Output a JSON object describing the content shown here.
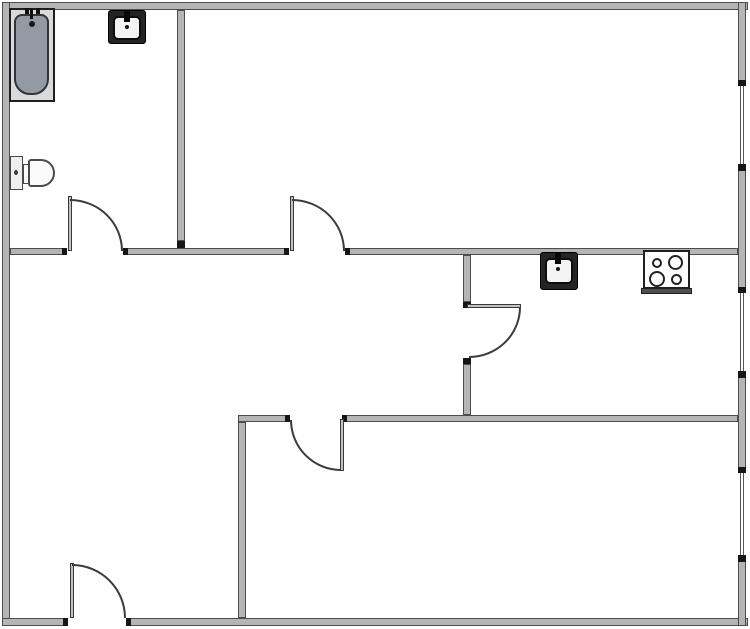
{
  "floorplan": {
    "canvas": {
      "width": 750,
      "height": 629,
      "background": "#ffffff"
    },
    "palette": {
      "wall_fill": "#b5b5b5",
      "wall_edge": "#4d4d4d",
      "jamb_black": "#161616",
      "door_line": "#3c3c3c",
      "sink_frame": "#242424",
      "sink_basin": "#f3f3f3",
      "tub_deck": "#dadada",
      "tub_basin": "#949aa3",
      "stove_fill": "#ffffff",
      "stove_front": "#4e4e4e",
      "toilet_fill": "#fbfbfb"
    },
    "walls": [
      {
        "name": "wall-exterior-top",
        "x": 2,
        "y": 2,
        "w": 746,
        "h": 8
      },
      {
        "name": "wall-exterior-left",
        "x": 2,
        "y": 2,
        "w": 8,
        "h": 624
      },
      {
        "name": "wall-exterior-bottom-left",
        "x": 2,
        "y": 618,
        "w": 66,
        "h": 8
      },
      {
        "name": "wall-exterior-bottom-right",
        "x": 126,
        "y": 618,
        "w": 622,
        "h": 8
      },
      {
        "name": "wall-exterior-right-1",
        "x": 738,
        "y": 2,
        "w": 8,
        "h": 84
      },
      {
        "name": "wall-exterior-right-2",
        "x": 738,
        "y": 164,
        "w": 8,
        "h": 129
      },
      {
        "name": "wall-exterior-right-3",
        "x": 738,
        "y": 371,
        "w": 8,
        "h": 102
      },
      {
        "name": "wall-exterior-right-4",
        "x": 738,
        "y": 555,
        "w": 8,
        "h": 71
      },
      {
        "name": "wall-interior-mid-1",
        "x": 10,
        "y": 248,
        "w": 57,
        "h": 7
      },
      {
        "name": "wall-interior-mid-2",
        "x": 123,
        "y": 248,
        "w": 166,
        "h": 7
      },
      {
        "name": "wall-interior-mid-3",
        "x": 345,
        "y": 248,
        "w": 393,
        "h": 7
      },
      {
        "name": "wall-bathroom-east",
        "x": 177,
        "y": 10,
        "w": 8,
        "h": 231
      },
      {
        "name": "wall-kitchen-west-1",
        "x": 463,
        "y": 255,
        "w": 8,
        "h": 47
      },
      {
        "name": "wall-kitchen-west-2",
        "x": 463,
        "y": 364,
        "w": 8,
        "h": 51
      },
      {
        "name": "wall-lower-north-1",
        "x": 238,
        "y": 415,
        "w": 52,
        "h": 7
      },
      {
        "name": "wall-lower-north-2",
        "x": 342,
        "y": 415,
        "w": 396,
        "h": 7
      },
      {
        "name": "wall-lower-west",
        "x": 238,
        "y": 422,
        "w": 8,
        "h": 196
      }
    ],
    "wall_caps": [
      {
        "name": "jamb",
        "x": 62,
        "y": 248,
        "w": 5,
        "h": 7
      },
      {
        "name": "jamb",
        "x": 123,
        "y": 248,
        "w": 5,
        "h": 7
      },
      {
        "name": "jamb",
        "x": 284,
        "y": 248,
        "w": 5,
        "h": 7
      },
      {
        "name": "jamb",
        "x": 345,
        "y": 248,
        "w": 5,
        "h": 7
      },
      {
        "name": "jamb",
        "x": 463,
        "y": 302,
        "w": 8,
        "h": 6
      },
      {
        "name": "jamb",
        "x": 463,
        "y": 358,
        "w": 8,
        "h": 6
      },
      {
        "name": "jamb",
        "x": 285,
        "y": 415,
        "w": 5,
        "h": 7
      },
      {
        "name": "jamb",
        "x": 342,
        "y": 415,
        "w": 5,
        "h": 7
      },
      {
        "name": "jamb",
        "x": 63,
        "y": 618,
        "w": 5,
        "h": 8
      },
      {
        "name": "jamb",
        "x": 126,
        "y": 618,
        "w": 5,
        "h": 8
      },
      {
        "name": "window-cap",
        "x": 738,
        "y": 80,
        "w": 8,
        "h": 6
      },
      {
        "name": "window-cap",
        "x": 738,
        "y": 164,
        "w": 8,
        "h": 7
      },
      {
        "name": "window-cap",
        "x": 738,
        "y": 287,
        "w": 8,
        "h": 6
      },
      {
        "name": "window-cap",
        "x": 738,
        "y": 371,
        "w": 8,
        "h": 7
      },
      {
        "name": "window-cap",
        "x": 738,
        "y": 467,
        "w": 8,
        "h": 6
      },
      {
        "name": "window-cap",
        "x": 738,
        "y": 555,
        "w": 8,
        "h": 7
      },
      {
        "name": "jamb",
        "x": 177,
        "y": 241,
        "w": 8,
        "h": 7
      }
    ],
    "windows": [
      {
        "name": "window-right-1",
        "x": 740,
        "y": 86,
        "w": 4,
        "h": 78
      },
      {
        "name": "window-right-2",
        "x": 740,
        "y": 293,
        "w": 4,
        "h": 78
      },
      {
        "name": "window-right-3",
        "x": 740,
        "y": 473,
        "w": 4,
        "h": 82
      }
    ],
    "doors": [
      {
        "name": "door-bathroom",
        "leaf": {
          "x": 68,
          "y": 196,
          "w": 4,
          "h": 55
        },
        "arc": {
          "x": 70,
          "y": 199,
          "w": 53,
          "h": 52,
          "q": "tr"
        }
      },
      {
        "name": "door-top-room",
        "leaf": {
          "x": 290,
          "y": 196,
          "w": 4,
          "h": 55
        },
        "arc": {
          "x": 292,
          "y": 199,
          "w": 53,
          "h": 52,
          "q": "tr"
        }
      },
      {
        "name": "door-kitchen",
        "leaf": {
          "x": 467,
          "y": 304,
          "w": 54,
          "h": 4
        },
        "arc": {
          "x": 469,
          "y": 307,
          "w": 52,
          "h": 51,
          "q": "br"
        }
      },
      {
        "name": "door-lower-room",
        "leaf": {
          "x": 340,
          "y": 419,
          "w": 4,
          "h": 52
        },
        "arc": {
          "x": 290,
          "y": 420,
          "w": 51,
          "h": 51,
          "q": "bl"
        }
      },
      {
        "name": "door-entry",
        "leaf": {
          "x": 70,
          "y": 563,
          "w": 4,
          "h": 55
        },
        "arc": {
          "x": 72,
          "y": 564,
          "w": 54,
          "h": 54,
          "q": "tr"
        }
      }
    ],
    "fixtures": [
      {
        "name": "bathtub-surround",
        "x": 9,
        "y": 8,
        "w": 46,
        "h": 94,
        "fill": "#dadada",
        "stroke": "#1f1f1f",
        "sw": 2
      },
      {
        "name": "bathtub-basin",
        "x": 14,
        "y": 14,
        "w": 35,
        "h": 81,
        "fill": "#949aa3",
        "stroke": "#30343a",
        "sw": 2,
        "radius": "8px 8px 16px 16px"
      },
      {
        "name": "bathtub-faucet-tick-left",
        "x": 25,
        "y": 8,
        "w": 4,
        "h": 6,
        "fill": "#101010"
      },
      {
        "name": "bathtub-faucet-tick-right",
        "x": 36,
        "y": 8,
        "w": 4,
        "h": 6,
        "fill": "#101010"
      },
      {
        "name": "bathtub-faucet-stem",
        "x": 30,
        "y": 8,
        "w": 3,
        "h": 11,
        "fill": "#101010"
      },
      {
        "name": "bathtub-drain-dot",
        "x": 29,
        "y": 21,
        "w": 6,
        "h": 6,
        "fill": "#1a1a1a",
        "radius": "50%"
      },
      {
        "name": "bathroom-sink-frame",
        "x": 108,
        "y": 10,
        "w": 38,
        "h": 34,
        "fill": "#242424",
        "stroke": "#000000",
        "sw": 1,
        "radius": "3px"
      },
      {
        "name": "bathroom-sink-basin",
        "x": 113,
        "y": 16,
        "w": 28,
        "h": 24,
        "fill": "#f3f3f3",
        "stroke": "#0d0d0d",
        "sw": 2,
        "radius": "5px"
      },
      {
        "name": "bathroom-sink-faucet",
        "x": 124,
        "y": 11,
        "w": 6,
        "h": 11,
        "fill": "#080808"
      },
      {
        "name": "bathroom-sink-dot",
        "x": 125,
        "y": 25,
        "w": 4,
        "h": 4,
        "fill": "#161616",
        "radius": "50%"
      },
      {
        "name": "toilet-tank",
        "x": 10,
        "y": 156,
        "w": 13,
        "h": 34,
        "fill": "#efefef",
        "stroke": "#4a4a4a",
        "sw": 1.5
      },
      {
        "name": "toilet-flush-dot",
        "x": 14,
        "y": 170,
        "w": 4,
        "h": 5,
        "fill": "#3a3a3a",
        "radius": "50%"
      },
      {
        "name": "toilet-neck",
        "x": 23,
        "y": 164,
        "w": 7,
        "h": 20,
        "fill": "#fbfbfb",
        "stroke": "#4a4a4a",
        "sw": 1.5
      },
      {
        "name": "toilet-bowl",
        "x": 28,
        "y": 159,
        "w": 27,
        "h": 28,
        "fill": "#fbfbfb",
        "stroke": "#4a4a4a",
        "sw": 2,
        "radius": "3px 14px 14px 3px"
      },
      {
        "name": "kitchen-sink-frame",
        "x": 540,
        "y": 252,
        "w": 38,
        "h": 38,
        "fill": "#242424",
        "stroke": "#000000",
        "sw": 1,
        "radius": "3px"
      },
      {
        "name": "kitchen-sink-basin",
        "x": 545,
        "y": 258,
        "w": 28,
        "h": 26,
        "fill": "#f3f3f3",
        "stroke": "#0d0d0d",
        "sw": 2,
        "radius": "5px"
      },
      {
        "name": "kitchen-sink-faucet",
        "x": 555,
        "y": 253,
        "w": 6,
        "h": 11,
        "fill": "#080808"
      },
      {
        "name": "kitchen-sink-dot",
        "x": 556,
        "y": 267,
        "w": 4,
        "h": 4,
        "fill": "#161616",
        "radius": "50%"
      },
      {
        "name": "stove-body",
        "x": 643,
        "y": 250,
        "w": 47,
        "h": 39,
        "fill": "#ffffff",
        "stroke": "#1f1f1f",
        "sw": 2
      },
      {
        "name": "stove-front-bar",
        "x": 641,
        "y": 288,
        "w": 51,
        "h": 6,
        "fill": "#4e4e4e",
        "stroke": "#1f1f1f",
        "sw": 1
      },
      {
        "name": "stove-burner-small-tl",
        "x": 652,
        "y": 258,
        "w": 10,
        "h": 10,
        "fill": "#ffffff",
        "stroke": "#222222",
        "sw": 2,
        "radius": "50%"
      },
      {
        "name": "stove-burner-large-tr",
        "x": 668,
        "y": 255,
        "w": 15,
        "h": 15,
        "fill": "#ffffff",
        "stroke": "#222222",
        "sw": 2,
        "radius": "50%"
      },
      {
        "name": "stove-burner-large-bl",
        "x": 649,
        "y": 271,
        "w": 16,
        "h": 16,
        "fill": "#ffffff",
        "stroke": "#222222",
        "sw": 2,
        "radius": "50%"
      },
      {
        "name": "stove-burner-small-br",
        "x": 671,
        "y": 274,
        "w": 11,
        "h": 11,
        "fill": "#ffffff",
        "stroke": "#222222",
        "sw": 2,
        "radius": "50%"
      }
    ]
  }
}
